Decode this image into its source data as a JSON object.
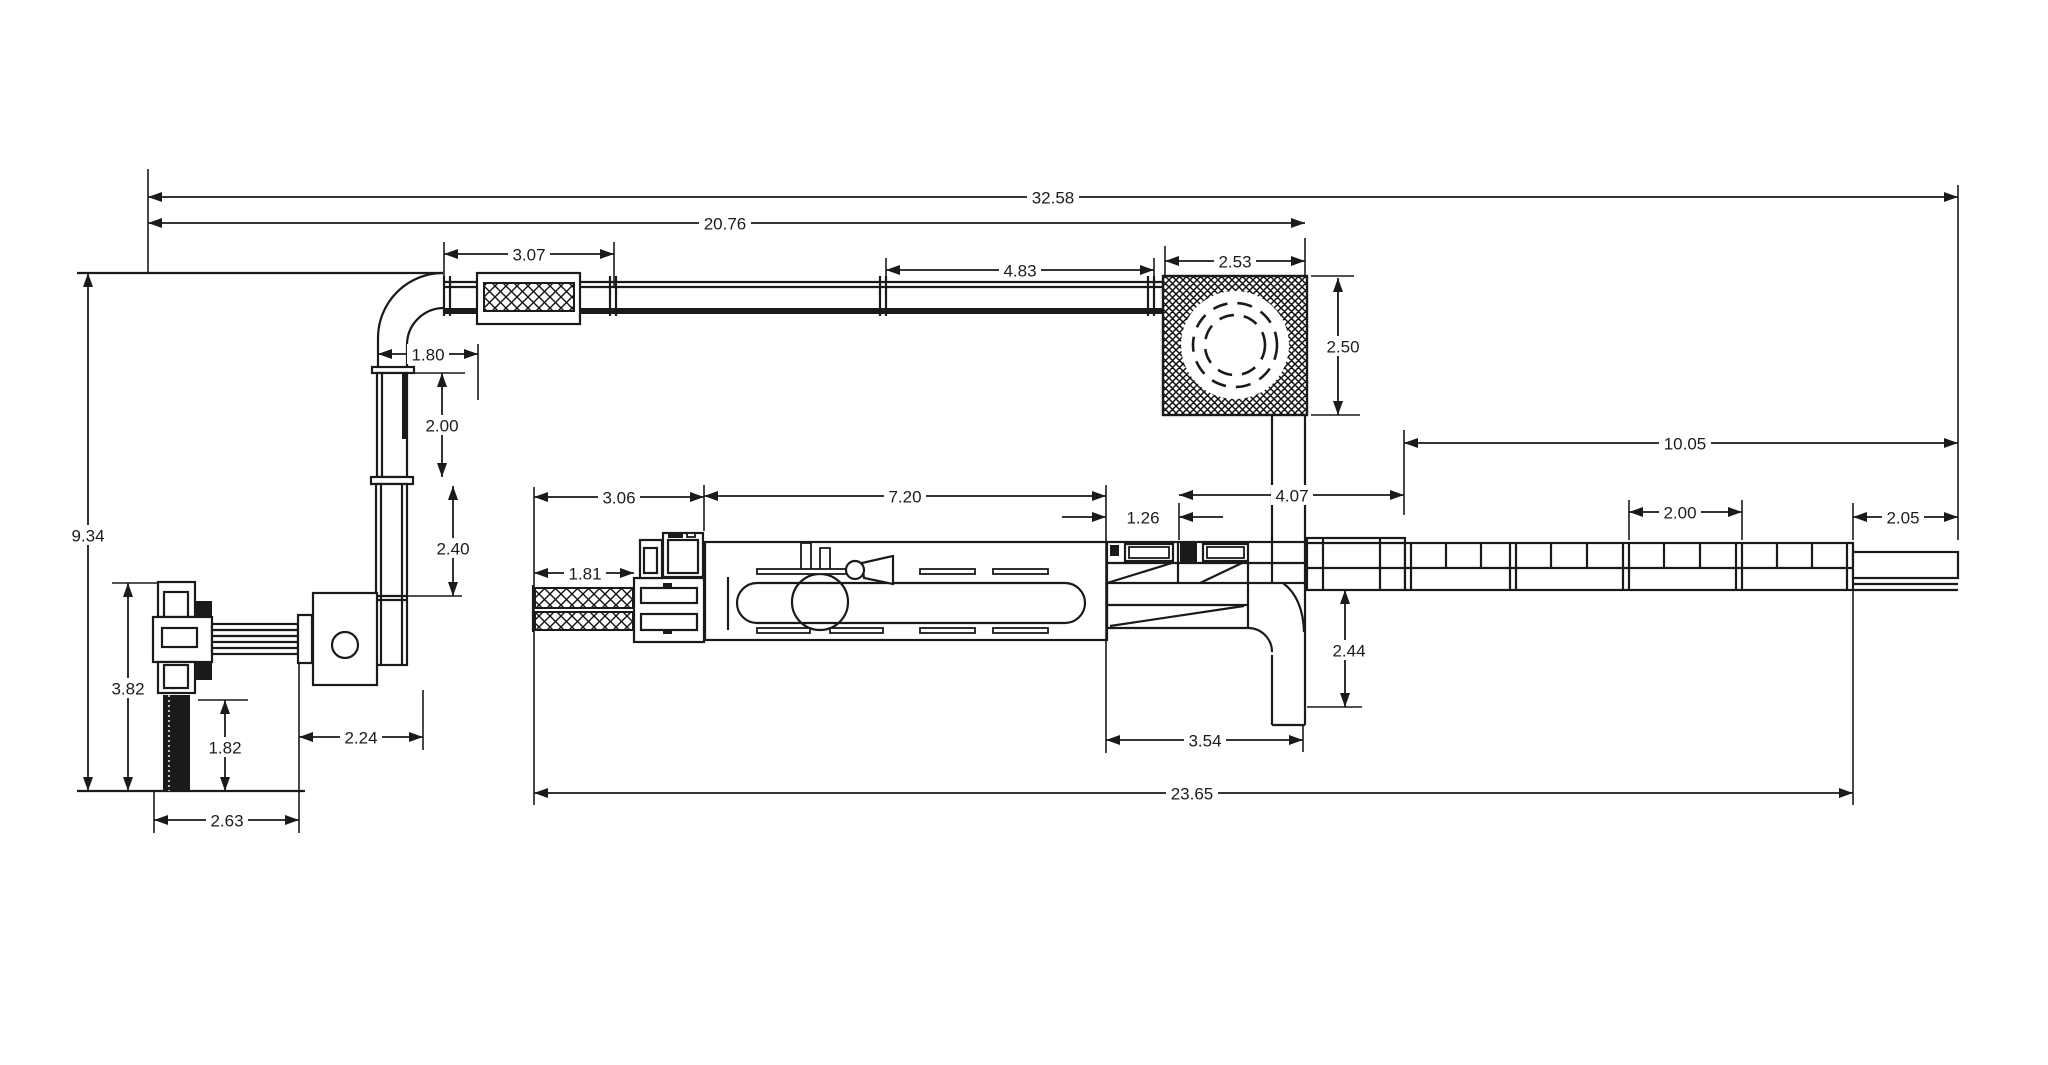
{
  "canvas": {
    "background": "#ffffff",
    "line_color": "#1a1a1a"
  },
  "dims": {
    "overall_length": "32.58",
    "top_run_length": "20.76",
    "top_unit_length": "3.07",
    "top_conveyor_span": "4.83",
    "rotary_width": "2.53",
    "rotary_height": "2.50",
    "elbow_offset": "1.80",
    "riser_upper": "2.00",
    "riser_lower": "2.40",
    "left_height": "9.34",
    "palletizer_height": "3.82",
    "post_height": "1.82",
    "palletizer_width": "2.63",
    "palletizer_offset": "2.24",
    "infeed_length": "3.06",
    "machine_length": "7.20",
    "transfer_gap": "1.26",
    "discharge_run": "4.07",
    "outfeed_length": "10.05",
    "outfeed_bay": "2.00",
    "outfeed_end": "2.05",
    "infeed_width": "1.81",
    "drop_height": "2.44",
    "drain_run": "3.54",
    "line_length": "23.65"
  }
}
